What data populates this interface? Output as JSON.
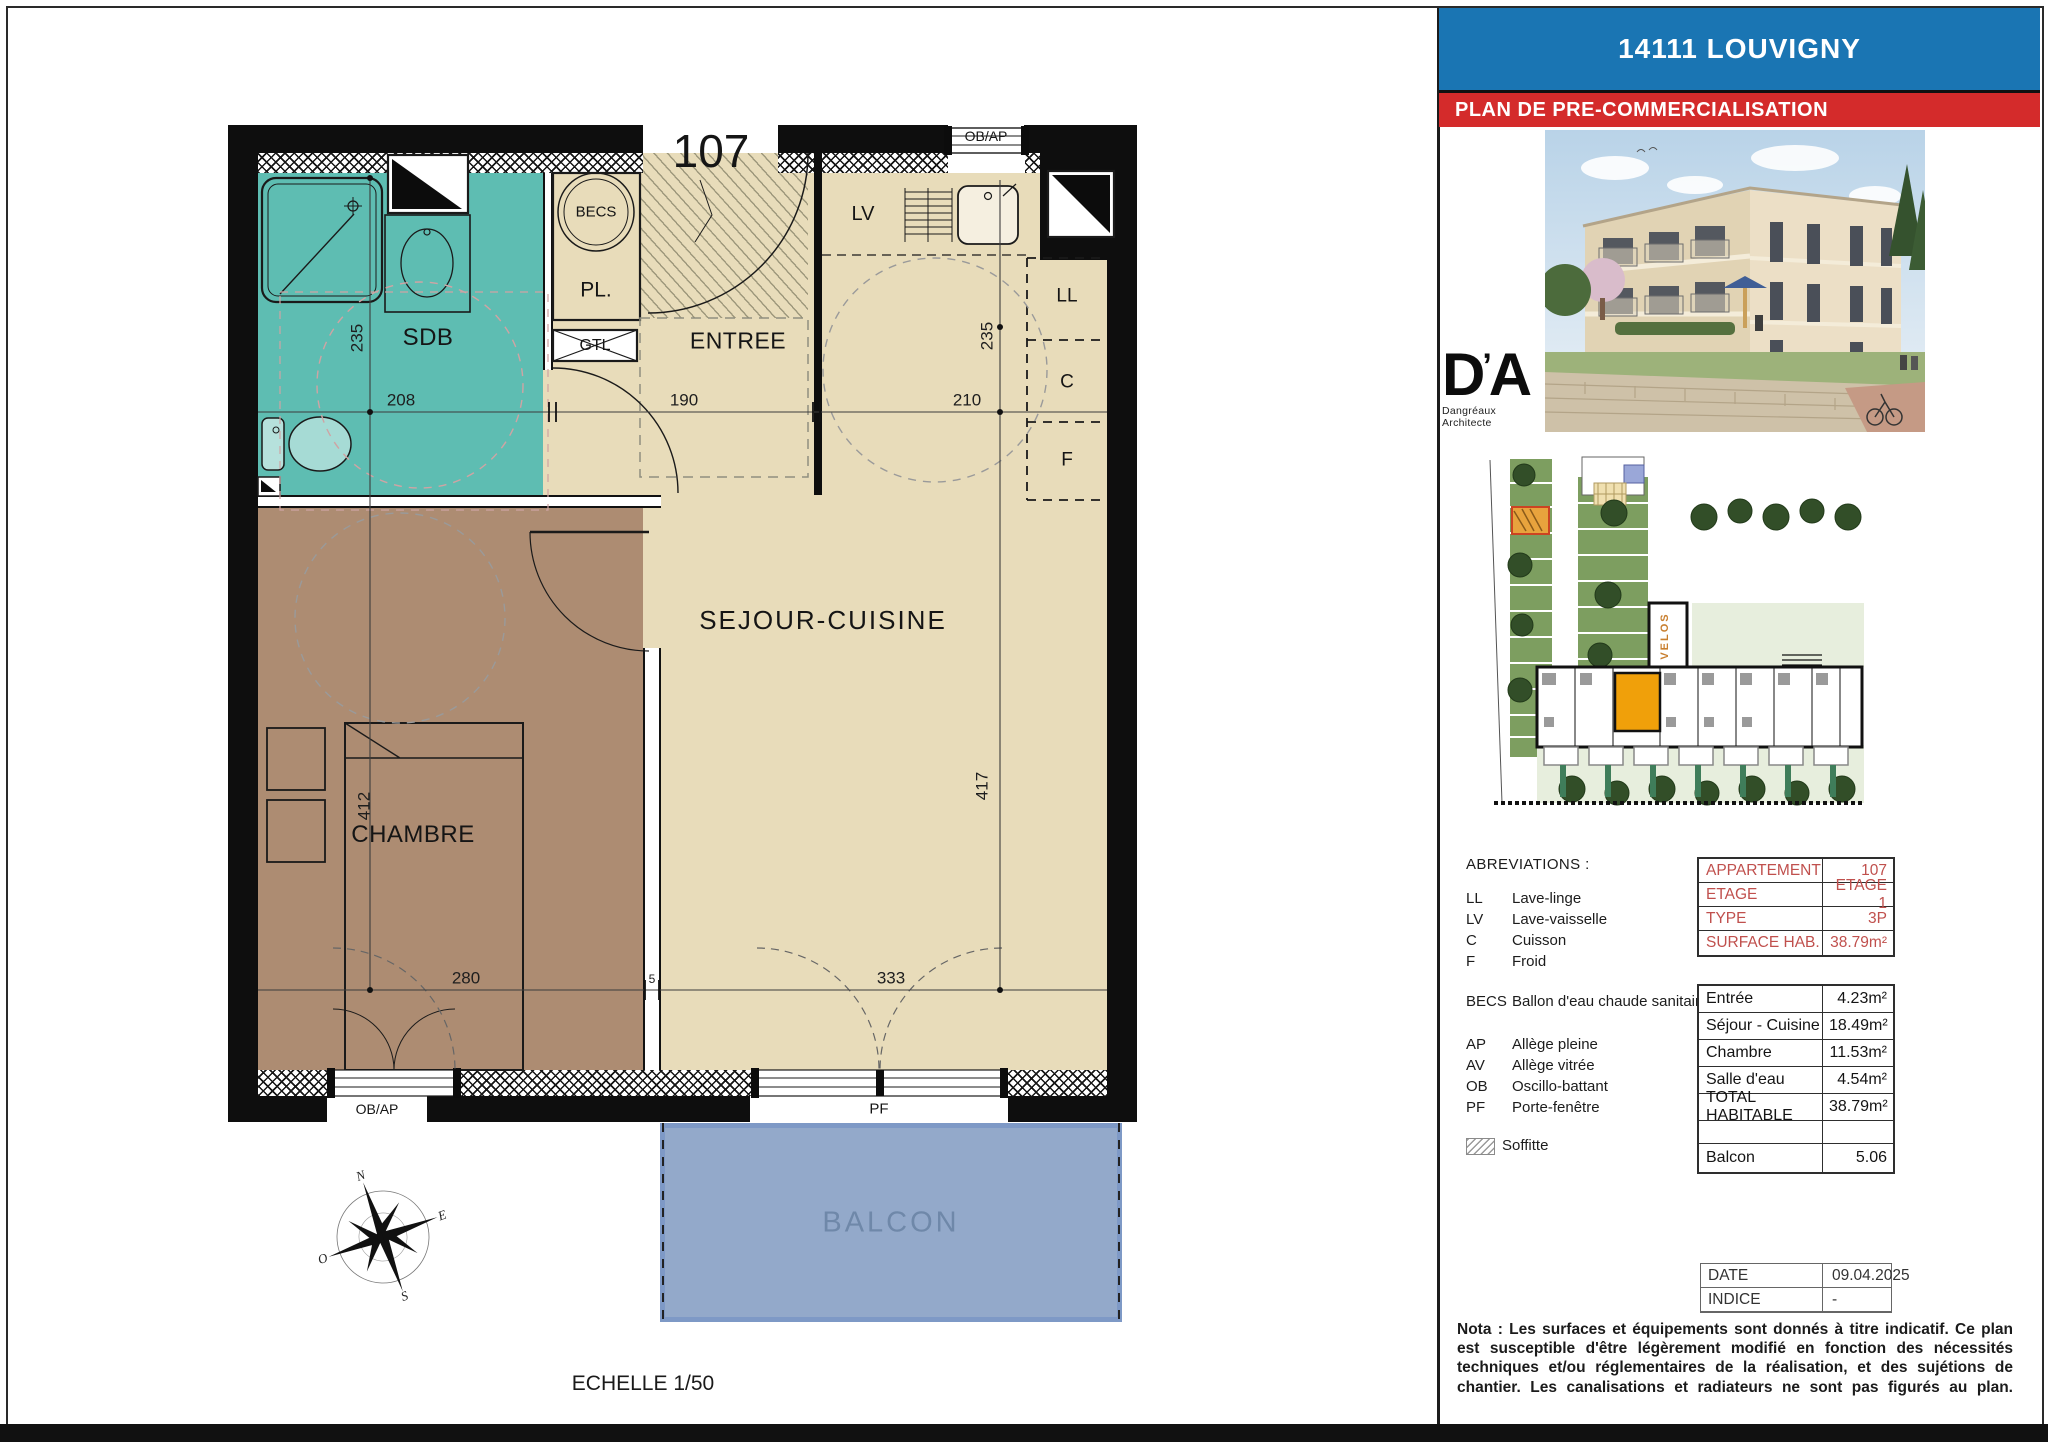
{
  "colors": {
    "teal": "#5ebdb2",
    "brown": "#ad8c72",
    "beige": "#e8dcba",
    "wall": "#0e0e0e",
    "balcony_fill": "#93a9ca",
    "balcony_border": "#7e99c6",
    "balcony_text": "#6f88a9",
    "header_blue": "#1a75b3",
    "header_red": "#d42b2b",
    "accent_red": "#c0504d",
    "site_green": "#7d9e60",
    "site_stipple": "#e7eedd",
    "unit_orange": "#f0a00a",
    "velos_orange": "#c87f2f"
  },
  "plan": {
    "apartment_number": "107",
    "scale_label": "ECHELLE 1/50",
    "rooms": {
      "sdb": "SDB",
      "entree": "ENTREE",
      "sejour": "SEJOUR-CUISINE",
      "chambre": "CHAMBRE",
      "balcon": "BALCON"
    },
    "equipment": {
      "becs": "BECS",
      "pl": "PL.",
      "gtl": "GTL",
      "lv": "LV",
      "ll": "LL",
      "c": "C",
      "f": "F"
    },
    "windows": {
      "top_ob_ap": "OB/AP",
      "bottom_ob_ap": "OB/AP",
      "pf": "PF"
    },
    "dims": {
      "sdb_w": "208",
      "entree_w": "190",
      "sejour_w": "210",
      "sdb_h": "235",
      "kitchen_h": "235",
      "chambre_h": "412",
      "sejour_h": "417",
      "chambre_w": "280",
      "partition": "5",
      "sejour_w2": "333"
    },
    "compass": {
      "n": "N",
      "e": "E",
      "s": "S",
      "o": "O"
    }
  },
  "panel": {
    "title": "14111 LOUVIGNY",
    "subtitle": "PLAN DE PRE-COMMERCIALISATION",
    "logo": {
      "d": "D",
      "apos": "’",
      "a": "A",
      "name": "Dangréaux Architecte"
    },
    "siteplan": {
      "velos": "VELOS"
    },
    "abbreviations": {
      "heading": "ABREVIATIONS :",
      "items": [
        {
          "abbr": "LL",
          "label": "Lave-linge"
        },
        {
          "abbr": "LV",
          "label": "Lave-vaisselle"
        },
        {
          "abbr": "C",
          "label": "Cuisson"
        },
        {
          "abbr": "F",
          "label": "Froid"
        },
        {
          "abbr": "BECS",
          "label": "Ballon d'eau chaude sanitaire"
        },
        {
          "abbr": "AP",
          "label": "Allège pleine"
        },
        {
          "abbr": "AV",
          "label": "Allège vitrée"
        },
        {
          "abbr": "OB",
          "label": "Oscillo-battant"
        },
        {
          "abbr": "PF",
          "label": "Porte-fenêtre"
        }
      ],
      "soffitte": "Soffitte"
    },
    "info_table": {
      "rows": [
        [
          "APPARTEMENT",
          "107"
        ],
        [
          "ETAGE",
          "ETAGE 1"
        ],
        [
          "TYPE",
          "3P"
        ],
        [
          "SURFACE HAB.",
          "38.79m²"
        ]
      ]
    },
    "surface_table": {
      "rows": [
        [
          "Entrée",
          "4.23m²"
        ],
        [
          "Séjour - Cuisine",
          "18.49m²"
        ],
        [
          "Chambre",
          "11.53m²"
        ],
        [
          "Salle d'eau",
          "4.54m²"
        ],
        [
          "TOTAL HABITABLE",
          "38.79m²"
        ]
      ],
      "balcon_row": [
        "Balcon",
        "5.06"
      ]
    },
    "meta_table": {
      "rows": [
        [
          "DATE",
          "09.04.2025"
        ],
        [
          "INDICE",
          "-"
        ]
      ]
    },
    "nota": "Nota : Les surfaces et équipements sont donnés à titre indicatif. Ce plan est susceptible d'être légèrement modifié en fonction des nécessités techniques et/ou réglementaires de la réalisation, et des sujétions de chantier. Les canalisations et radiateurs ne sont pas figurés au plan."
  }
}
